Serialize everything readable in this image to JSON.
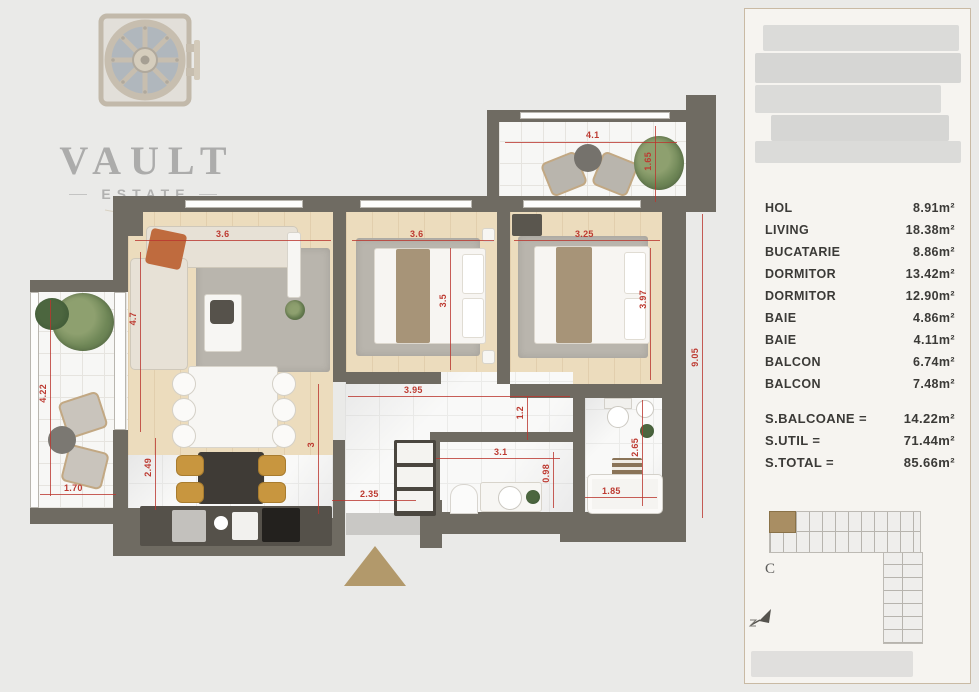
{
  "brand": {
    "name": "VAULT",
    "sub": "ESTATE"
  },
  "panel": {
    "rooms": [
      {
        "label": "HOL",
        "area": "8.91m²"
      },
      {
        "label": "LIVING",
        "area": "18.38m²"
      },
      {
        "label": "BUCATARIE",
        "area": "8.86m²"
      },
      {
        "label": "DORMITOR",
        "area": "13.42m²"
      },
      {
        "label": "DORMITOR",
        "area": "12.90m²"
      },
      {
        "label": "BAIE",
        "area": "4.86m²"
      },
      {
        "label": "BAIE",
        "area": "4.11m²"
      },
      {
        "label": "BALCON",
        "area": "6.74m²"
      },
      {
        "label": "BALCON",
        "area": "7.48m²"
      }
    ],
    "totals": [
      {
        "label": "S.BALCOANE =",
        "value": "14.22m²"
      },
      {
        "label": "S.UTIL =",
        "value": "71.44m²"
      },
      {
        "label": "S.TOTAL =",
        "value": "85.66m²"
      }
    ],
    "keyplan_label": "C"
  },
  "plan": {
    "dims": {
      "living_w": "3.6",
      "bed1_w": "3.6",
      "bed2_w": "3.25",
      "balc_top_w": "4.1",
      "balc_top_h": "1.65",
      "living_h": "4.7",
      "balc_left_h": "4.22",
      "balc_left_w": "1.70",
      "kitchen_h": "2.49",
      "dining_h": "3",
      "hall_w": "3.95",
      "hall_h": "1.2",
      "hall_bottom_w": "2.35",
      "bath1_w": "3.1",
      "bath1_h": "0.98",
      "bath2_w": "1.85",
      "bath2_h": "2.65",
      "right_h": "9.05",
      "bed1_h": "3.5",
      "bed2_h": "3.97"
    },
    "colors": {
      "wall": "#6f6b62",
      "dimension_red": "#bd3a31",
      "wood": "#ecdcbd",
      "accent_tan": "#b2996b",
      "keyplan_highlight": "#a98e63",
      "background": "#eaeae8"
    }
  }
}
